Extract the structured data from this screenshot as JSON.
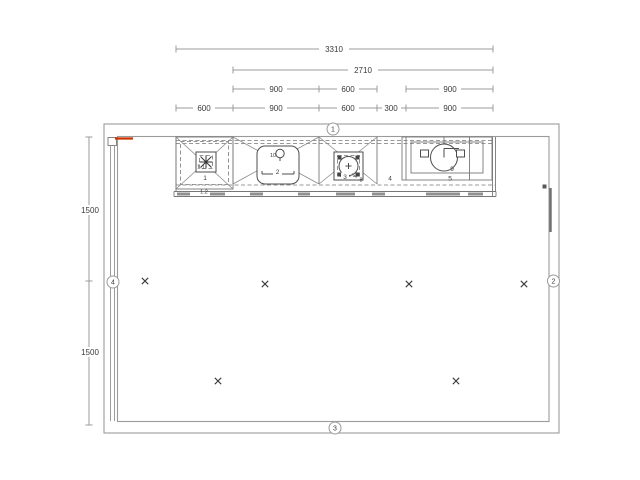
{
  "dimensions": {
    "total": "3310",
    "mid": "2710",
    "upper_row": [
      "900",
      "600",
      "900"
    ],
    "lower_row": [
      "600",
      "900",
      "600",
      "300",
      "900"
    ],
    "left_column": [
      "1500",
      "1500"
    ]
  },
  "wall_markers": {
    "top": "1",
    "right": "2",
    "bottom": "3",
    "left": "4"
  },
  "units": {
    "hood_unit": {
      "label": "1",
      "sub_top": "1.1",
      "sub_bottom": "1.2"
    },
    "sink_unit": {
      "label": "2",
      "faucet_label": "10"
    },
    "hob_unit": {
      "label": "3",
      "accessory_label": "8"
    },
    "filler": {
      "label": "4"
    },
    "right_unit": {
      "label": "5",
      "appliance_label": "9"
    }
  },
  "colors": {
    "line": "#9b9b9b",
    "dark_line": "#4d4d4d",
    "accent_red": "#cc3300",
    "text": "#3a3a3a",
    "background": "#ffffff"
  }
}
